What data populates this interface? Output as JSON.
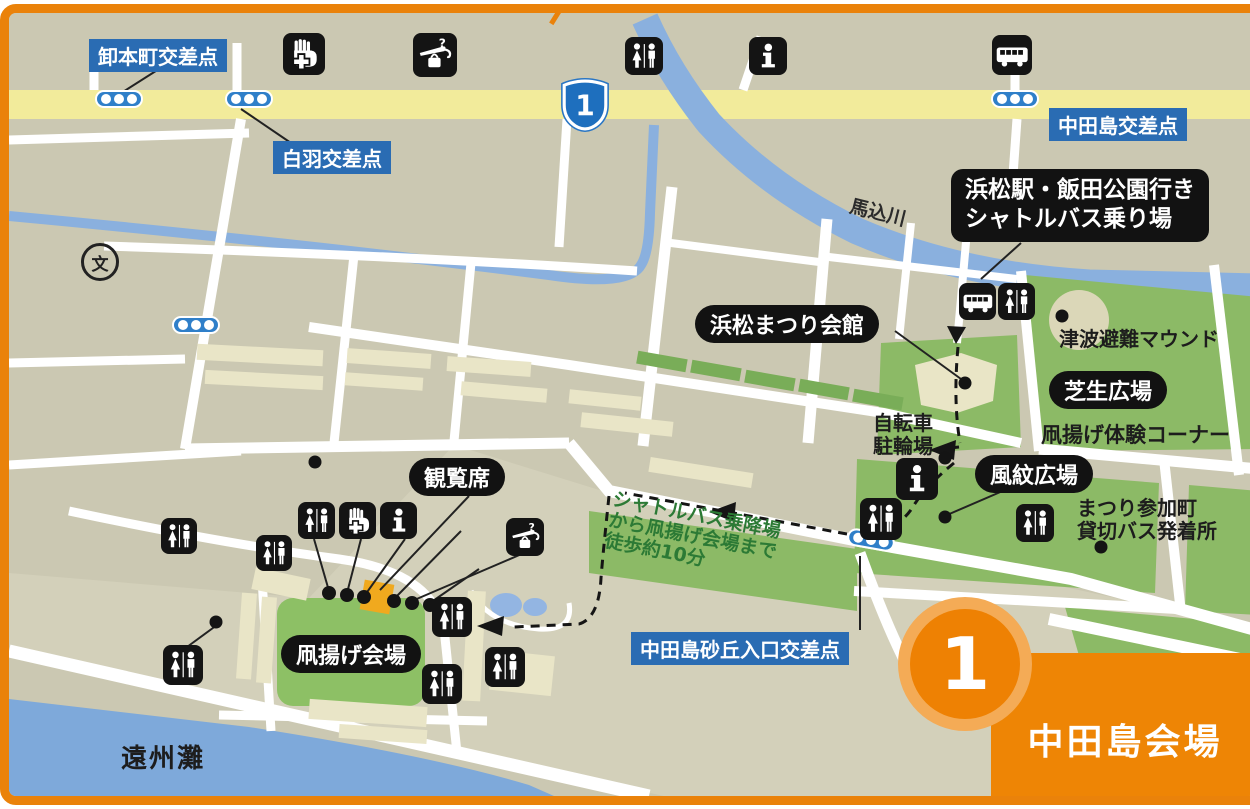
{
  "legend": {
    "items": [
      {
        "icon": "first-aid-icon",
        "label": "救護所"
      },
      {
        "icon": "lost-and-found-icon",
        "label": "忘れ物取扱所"
      },
      {
        "icon": "toilet-icon",
        "label": "トイレ"
      },
      {
        "icon": "information-icon",
        "label": "インフォメーション"
      },
      {
        "icon": "shuttle-bus-icon",
        "label": "シャトルバス乗降場"
      }
    ]
  },
  "route_shield": {
    "number": "1"
  },
  "intersections": {
    "oroshihoncho": "卸本町交差点",
    "shiraha": "白羽交差点",
    "nakatajima": "中田島交差点",
    "dune_entrance": "中田島砂丘入口交差点"
  },
  "places": {
    "shuttle_boarding_line1": "浜松駅・飯田公園行き",
    "shuttle_boarding_line2": "シャトルバス乗り場",
    "matsuri_hall": "浜松まつり会館",
    "lawn_plaza": "芝生広場",
    "wind_ripple_plaza": "風紋広場",
    "spectator_seats": "観覧席",
    "kite_flying_venue": "凧揚げ会場"
  },
  "texts": {
    "school": "砂丘小",
    "school_symbol": "文",
    "river": "馬込川",
    "tsunami_mound": "津波避難マウンド",
    "kite_experience_corner": "凧揚げ体験コーナー",
    "bicycle_parking_line1": "自転車",
    "bicycle_parking_line2": "駐輪場",
    "participating_towns_line1": "まつり参加町",
    "participating_towns_line2": "貸切バス発着所",
    "taxi_stand": "タクシー乗降場",
    "headquarters": "本部",
    "shop_1": "売店",
    "shop_2": "売店",
    "shop_3": "売店",
    "camp_1": "陣屋",
    "camp_2": "陣屋",
    "dune": "中田島砂丘",
    "sea": "遠州灘"
  },
  "walk_note": {
    "line1": "シャトルバス乗降場",
    "line2": "から凧揚げ会場まで",
    "line3": "徒歩約10分"
  },
  "venue_badge": {
    "number": "1",
    "name": "中田島会場"
  },
  "colors": {
    "accent_orange": "#ee8505",
    "label_blue": "#2a6cb3",
    "map_green": "#8cba66",
    "water_blue": "#8ab0de",
    "road_yellow": "#f2eb9b"
  }
}
